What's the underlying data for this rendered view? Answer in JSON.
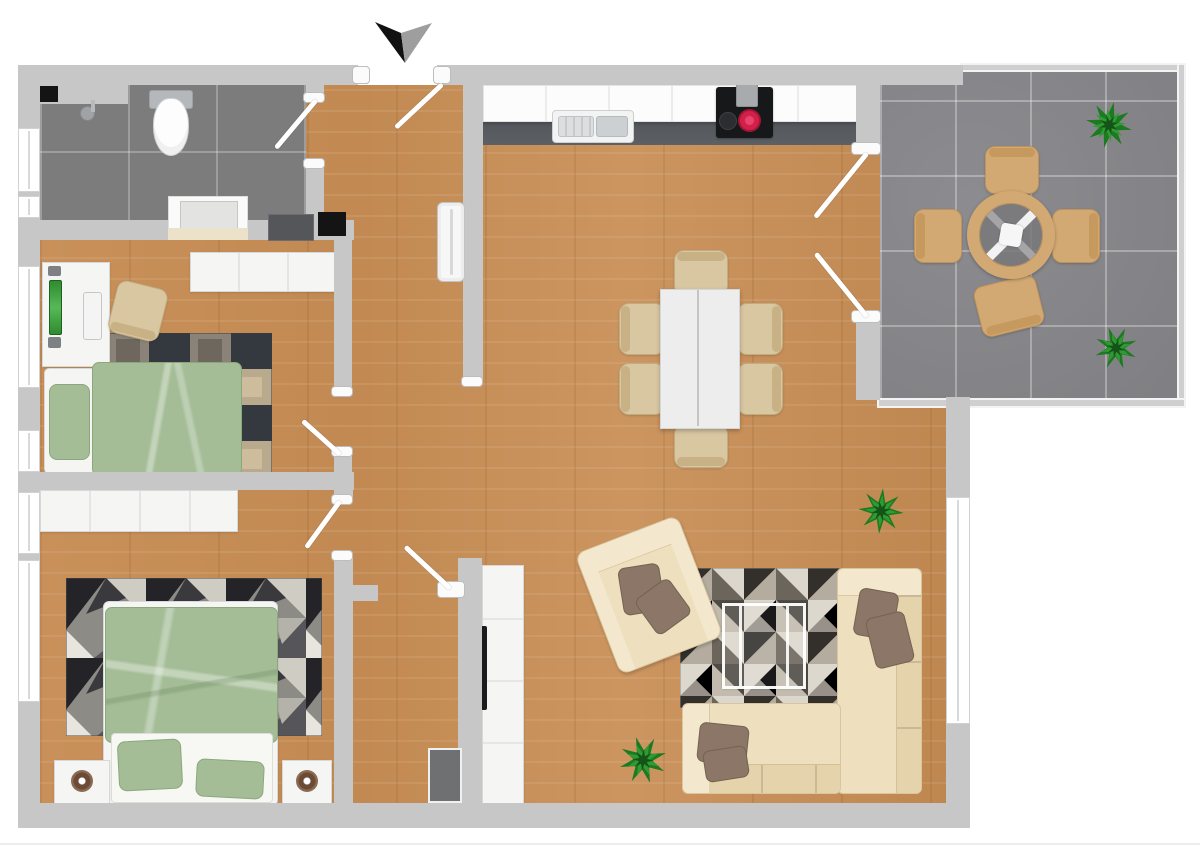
{
  "canvas": {
    "width": 1200,
    "height": 848
  },
  "scene": {
    "type": "3d-apartment-floor-plan-top-view",
    "rooms": [
      {
        "id": "bathroom",
        "area": "top-left",
        "floor": "dark-gray-tile"
      },
      {
        "id": "hallway",
        "area": "center",
        "floor": "wood"
      },
      {
        "id": "home-office-bedroom",
        "area": "middle-left",
        "floor": "wood"
      },
      {
        "id": "master-bedroom",
        "area": "bottom-left",
        "floor": "wood"
      },
      {
        "id": "kitchen",
        "area": "top-center",
        "floor": "wood"
      },
      {
        "id": "living-dining-room",
        "area": "center-right",
        "floor": "wood"
      },
      {
        "id": "balcony",
        "area": "top-right",
        "floor": "gray-tile"
      }
    ],
    "entrance_marker": "black-and-gray arrow pointing down at entry door",
    "door_count": {
      "entry": 1,
      "interior": 5,
      "balcony_french_doors": 2
    },
    "window_sides": [
      "left outer wall x5",
      "right living room wall x1"
    ]
  },
  "palette": {
    "wall": "#c7c7c7",
    "wallCap": "#fbfbfb",
    "wood": "#c68e57",
    "bathTile": "#7c7c7c",
    "balconyTile": "#86868a",
    "rail": "#cfcfcf",
    "kitchenStrip": "#5c6064",
    "counter": "#fcfcfc",
    "stove": "#17181a",
    "burnerRed": "#d22049",
    "green": "#a4bd96",
    "greenEdge": "#8aa87c",
    "sheet": "#f7f7f4",
    "pillowBrown": "#8b7668",
    "sofa": "#eee0bf",
    "sofaBack": "#e5d3ac",
    "sofaArm": "#f3e8cd",
    "chairBeige": "#d9c7a2",
    "chairBack": "#c8b285",
    "woodChair": "#d2a873",
    "woodChairEdge": "#bf935c",
    "plantDark": "#1d7a20",
    "plantMid": "#2f9b33",
    "plantDeep": "#145417",
    "tv": "#1b1b1b",
    "applianceDark": "#54565a",
    "applianceBlack": "#141414",
    "mat": "#6e7072",
    "frame": "#f5f5f4",
    "frameEdge": "#d8d8d8",
    "glassLine": "#d9d9d9",
    "arrowBlack": "#111111",
    "arrowGray": "#9e9e9e"
  },
  "furniture": {
    "bathroom": [
      "walk-in-shower",
      "shower-drain-mat-black",
      "toilet",
      "vanity-sink",
      "washing-machine",
      "dryer-black"
    ],
    "kitchen": [
      "counter-run-white",
      "double-sink",
      "cooktop-stove-red-burner"
    ],
    "living_dining": [
      "dining-table-white",
      "dining-chair x6",
      "corner-sofa-cream",
      "armchair-cream",
      "glass-coffee-table",
      "geometric-triangle-rug",
      "tv-sideboard-white",
      "wall-tv",
      "potted-plant x2"
    ],
    "home_office_bedroom": [
      "desk-white",
      "monitor-green",
      "keyboard-white",
      "desk-chair-beige",
      "single-bed-green",
      "patchwork-rug",
      "wardrobe-white"
    ],
    "master_bedroom": [
      "double-bed-green",
      "green-pillow x2",
      "nightstand x2",
      "wardrobe-white",
      "dark-geometric-rug"
    ],
    "balcony": [
      "round-table-wood-glass",
      "bistro-chair x4",
      "potted-plant x2"
    ],
    "hallway": [
      "radiator-white",
      "doormat-dark"
    ]
  }
}
